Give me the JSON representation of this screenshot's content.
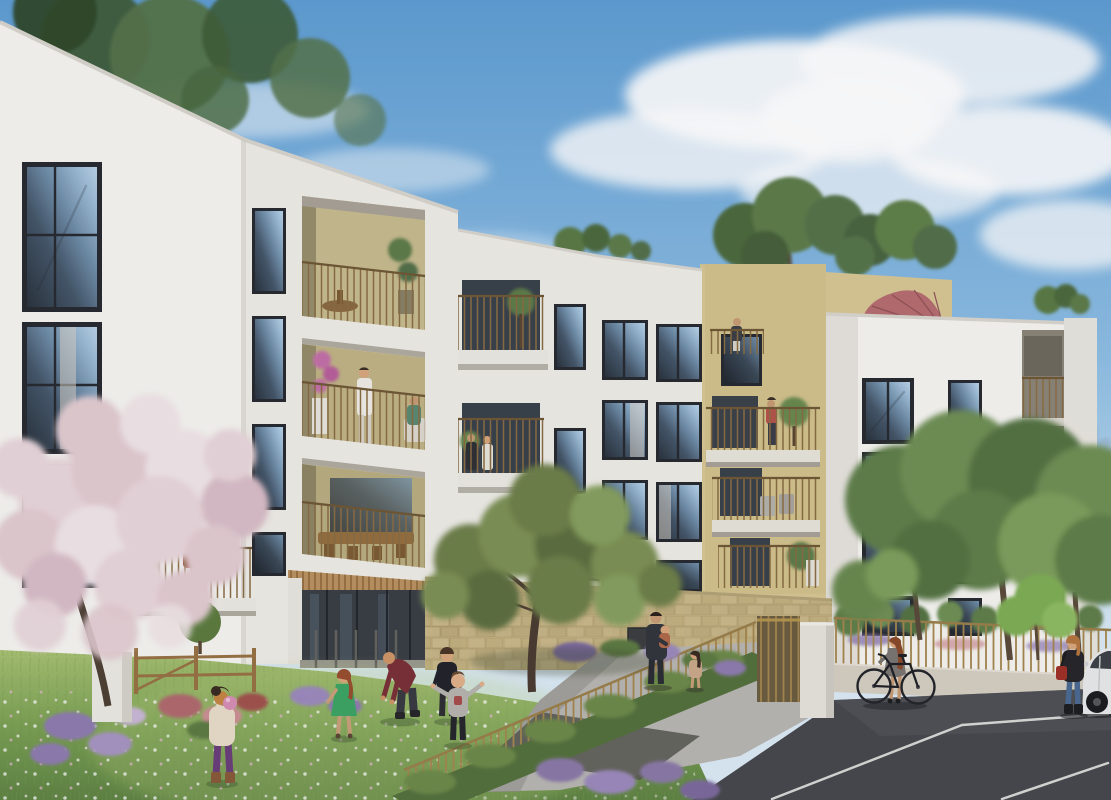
{
  "scene": {
    "description": "Photorealistic architectural rendering of a modern white residential complex with gold-slat balconies and a beige roof-terrace block with a dusty-pink parasol, viewed from a wildflower courtyard where children play; a gold fence, gate and hedge separate the lawn from a dark asphalt parking area with a white car, under a blue sky with soft clouds.",
    "time": "daytime",
    "medium": "exterior architectural visualization"
  },
  "palette": {
    "sky_top": "#5f9ed4",
    "sky_mid": "#8fbfe4",
    "sky_horizon": "#dcebf6",
    "cloud": "#ffffff",
    "wall_bright": "#f6f5f1",
    "wall_lit": "#efede7",
    "wall_shade": "#e2dfd8",
    "loggia_beige": "#c7bb8e",
    "facade_beige": "#d8c794",
    "window_frame": "#272b30",
    "glass_light": "#8fb4d4",
    "glass_dark": "#2a333d",
    "railing_gold": "#8a6d43",
    "fence_gold": "#a5874f",
    "stone": "#c8b788",
    "wood_soffit": "#bb9260",
    "lawn_light": "#a8c272",
    "lawn": "#7ba153",
    "lawn_dark": "#5f8443",
    "hedge": "#55713d",
    "path": "#b9b7b2",
    "asphalt": "#47484c",
    "parking_line": "#e8e8e6",
    "blossom": "#e9d7db",
    "foliage": "#6e8049",
    "foliage_dark": "#4e6a3e",
    "foliage_bright": "#7fae55",
    "umbrella": "#b76d70",
    "flowers_purple": "#8f7bb0",
    "flowers_pink": "#cf8f96",
    "car_body": "#e9eaea",
    "bag_red": "#a03028",
    "ball_pink": "#d98fb5",
    "dress_green": "#3da563",
    "polo_red": "#7b3038",
    "highrise_blue": "#9ab4cc"
  },
  "buildings": {
    "left": {
      "label": "white block, corner windows, recessed beige loggias",
      "floors": 5
    },
    "center": {
      "label": "white block, stacked balconies and window grid",
      "floors": 5
    },
    "right": {
      "label": "white block with recessed balcony bay",
      "floors": 4
    },
    "rear": {
      "label": "beige block with roof garden and parasol",
      "floors": 2
    }
  },
  "objects": {
    "parasol": {
      "label": "dusty-pink roof parasol"
    },
    "bicycle": {
      "label": "black city bicycle"
    },
    "car": {
      "label": "white car, partly out of frame"
    },
    "gate": {
      "label": "gold slatted pedestrian gate with white pillar"
    },
    "fence": {
      "label": "gold metal fence on low wall"
    },
    "hedge": {
      "label": "clipped hedge along the fence"
    },
    "topiary": {
      "label": "clipped topiary ball"
    },
    "wood_fence": {
      "label": "small wooden garden fence"
    }
  },
  "people": [
    {
      "label": "girl in purple leggings holding a pink ball"
    },
    {
      "label": "red-haired girl in a green dress"
    },
    {
      "label": "man in dark red polo bending in the meadow"
    },
    {
      "label": "boy in black t-shirt"
    },
    {
      "label": "toddler in grey t-shirt with arms out"
    },
    {
      "label": "man carrying a child on the path"
    },
    {
      "label": "small girl by the hedge"
    },
    {
      "label": "woman in grey dress with a bicycle"
    },
    {
      "label": "woman in black jacket with red bag beside the car"
    },
    {
      "label": "woman seated on a left balcony"
    },
    {
      "label": "man in white on a second-floor loggia"
    },
    {
      "label": "couple on a centre balcony"
    },
    {
      "label": "resident on a rear balcony"
    }
  ]
}
